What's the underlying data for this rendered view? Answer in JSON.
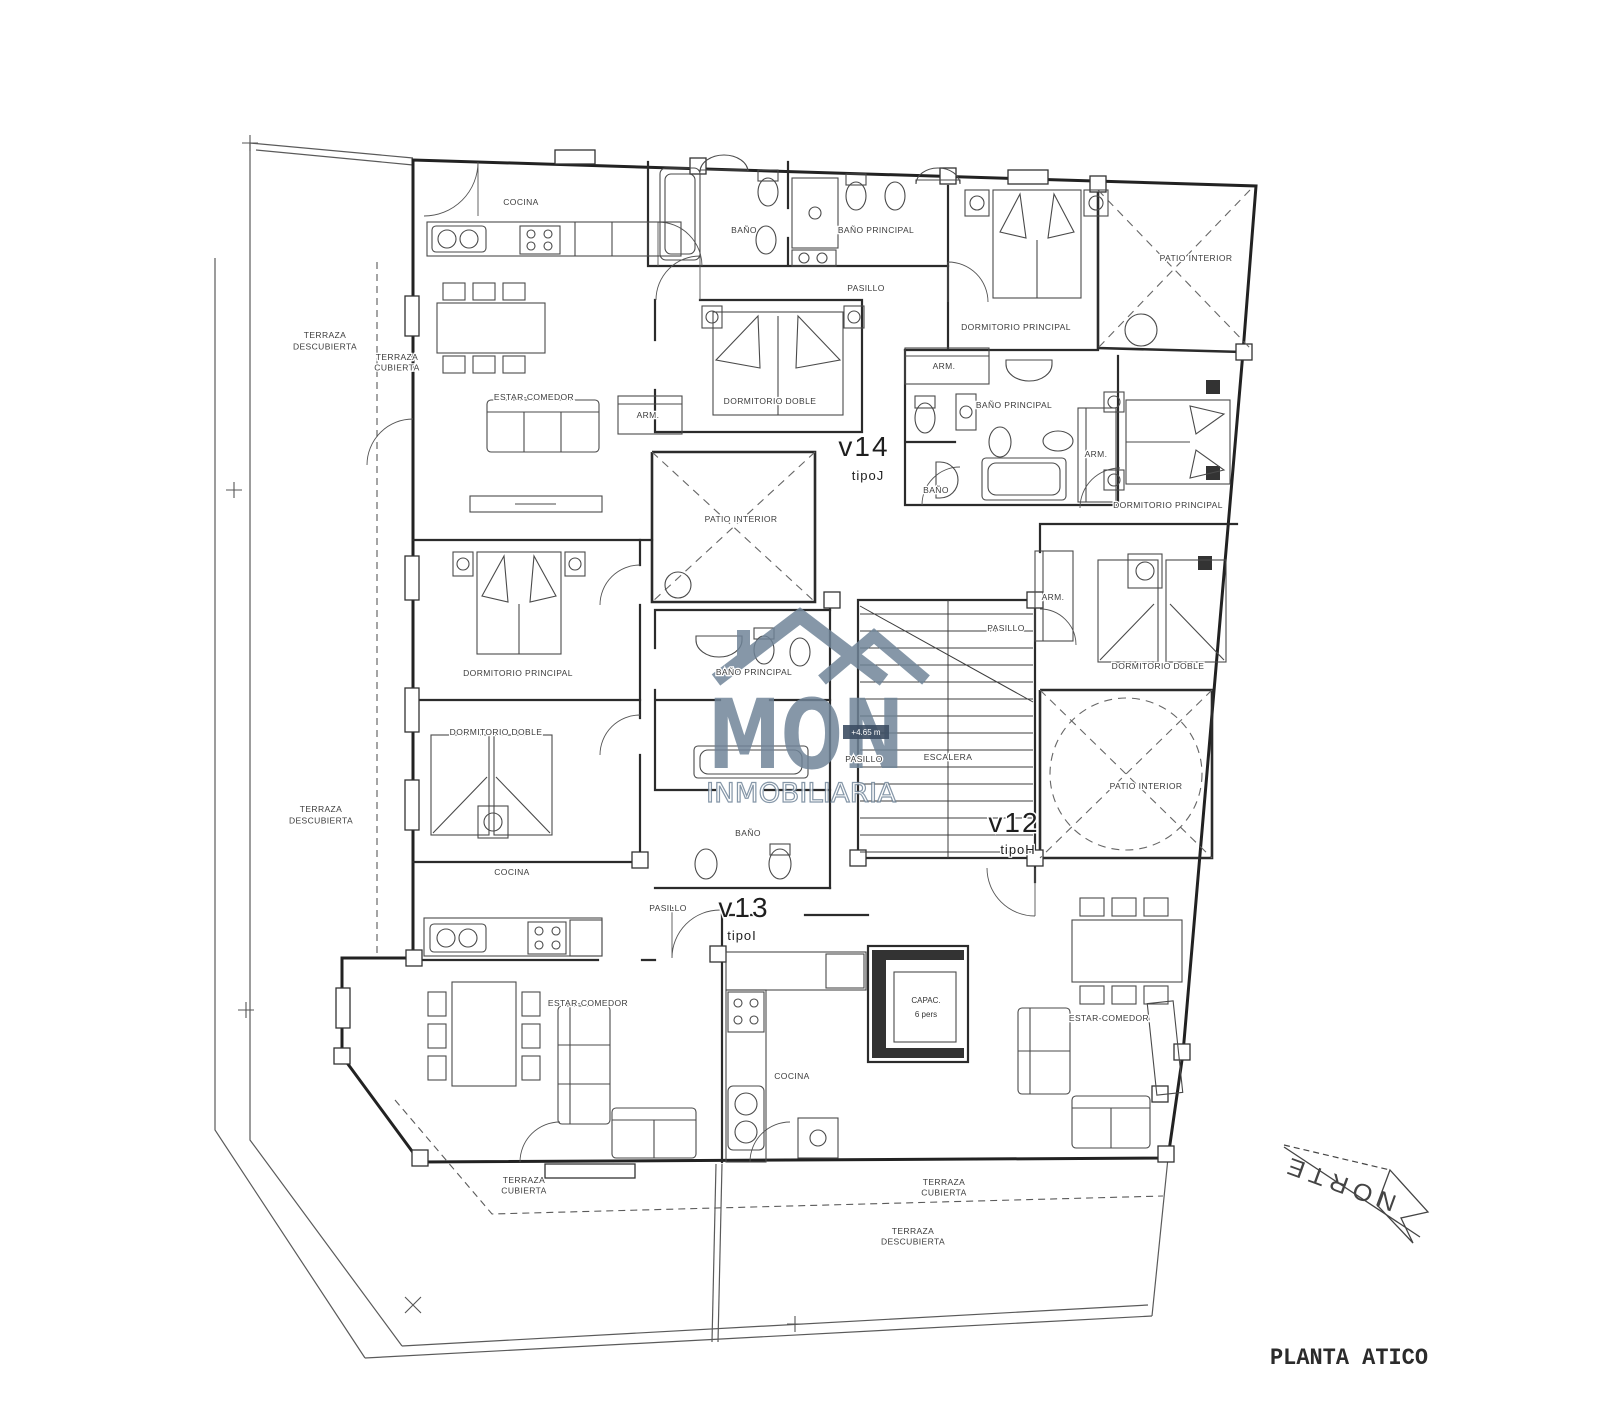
{
  "title": {
    "text": "PLANTA ATICO"
  },
  "north": {
    "label": "NORTE"
  },
  "watermark": {
    "brand": "MON",
    "subtitle": "INMOBILIARIA",
    "color": "#6f8498"
  },
  "level_badge": {
    "text": "+4.65 m"
  },
  "elevator": {
    "line1": "CAPAC.",
    "line2": "6 pers"
  },
  "units": [
    {
      "id": "v12",
      "tipo": "tipoH"
    },
    {
      "id": "v13",
      "tipo": "tipoI"
    },
    {
      "id": "v14",
      "tipo": "tipoJ"
    }
  ],
  "room_labels": [
    {
      "name": "label-cocina-v14",
      "text": "COCINA",
      "x": 521,
      "y": 205
    },
    {
      "name": "label-bano-v14",
      "text": "BAÑO",
      "x": 744,
      "y": 233
    },
    {
      "name": "label-bano-principal-v14",
      "text": "BAÑO PRINCIPAL",
      "x": 876,
      "y": 233
    },
    {
      "name": "label-pasillo-v14",
      "text": "PASILLO",
      "x": 866,
      "y": 291,
      "fs": 7.5
    },
    {
      "name": "label-terraza-descubierta-upper",
      "lines": [
        "TERRAZA",
        "DESCUBIERTA"
      ],
      "x": 325,
      "y": 338
    },
    {
      "name": "label-terraza-cubierta-left",
      "lines": [
        "TERRAZA",
        "CUBIERTA"
      ],
      "x": 397,
      "y": 360,
      "fs": 7.5
    },
    {
      "name": "label-estar-comedor-v14",
      "text": "ESTAR-COMEDOR",
      "x": 534,
      "y": 400
    },
    {
      "name": "label-dormitorio-doble-v14",
      "text": "DORMITORIO DOBLE",
      "x": 770,
      "y": 404
    },
    {
      "name": "label-arm-v14",
      "text": "ARM.",
      "x": 648,
      "y": 418,
      "fs": 7.5
    },
    {
      "name": "label-dormitorio-principal-tr",
      "text": "DORMITORIO PRINCIPAL",
      "x": 1016,
      "y": 330
    },
    {
      "name": "label-arm-tr",
      "text": "ARM.",
      "x": 944,
      "y": 369,
      "fs": 7.5
    },
    {
      "name": "label-patio-interior-tr",
      "text": "PATIO INTERIOR",
      "x": 1196,
      "y": 261
    },
    {
      "name": "unit-v14",
      "text": "v14",
      "x": 864,
      "y": 456,
      "fs": 28,
      "cls": "unit"
    },
    {
      "name": "unit-v14-tipo",
      "text": "tipoJ",
      "x": 868,
      "y": 480,
      "fs": 13,
      "cls": "tipo"
    },
    {
      "name": "label-patio-interior-v14",
      "text": "PATIO INTERIOR",
      "x": 741,
      "y": 522
    },
    {
      "name": "label-bano-principal-v12",
      "text": "BAÑO PRINCIPAL",
      "x": 1014,
      "y": 408
    },
    {
      "name": "label-arm-v12-upper",
      "text": "ARM.",
      "x": 1096,
      "y": 457,
      "fs": 7.5
    },
    {
      "name": "label-bano-v12",
      "text": "BAÑO",
      "x": 936,
      "y": 493
    },
    {
      "name": "label-dormitorio-principal-v12",
      "text": "DORMITORIO PRINCIPAL",
      "x": 1168,
      "y": 508
    },
    {
      "name": "label-arm-v12-mid",
      "text": "ARM.",
      "x": 1053,
      "y": 600,
      "fs": 7.5
    },
    {
      "name": "label-pasillo-v12",
      "text": "PASILLO",
      "x": 1006,
      "y": 631,
      "fs": 7.5
    },
    {
      "name": "label-dormitorio-doble-v12",
      "text": "DORMITORIO DOBLE",
      "x": 1158,
      "y": 669
    },
    {
      "name": "label-patio-interior-v12",
      "text": "PATIO INTERIOR",
      "x": 1146,
      "y": 789
    },
    {
      "name": "unit-v12",
      "text": "v12",
      "x": 1014,
      "y": 832,
      "fs": 28,
      "cls": "unit"
    },
    {
      "name": "unit-v12-tipo",
      "text": "tipoH",
      "x": 1018,
      "y": 854,
      "fs": 13,
      "cls": "tipo"
    },
    {
      "name": "label-dormitorio-principal-v13",
      "text": "DORMITORIO PRINCIPAL",
      "x": 518,
      "y": 676
    },
    {
      "name": "label-bano-principal-v13",
      "text": "BAÑO PRINCIPAL",
      "x": 754,
      "y": 675
    },
    {
      "name": "label-dormitorio-doble-v13",
      "text": "DORMITORIO DOBLE",
      "x": 496,
      "y": 735
    },
    {
      "name": "label-terraza-descubierta-lower",
      "lines": [
        "TERRAZA",
        "DESCUBIERTA"
      ],
      "x": 321,
      "y": 812
    },
    {
      "name": "label-bano-v13",
      "text": "BAÑO",
      "x": 748,
      "y": 836
    },
    {
      "name": "label-cocina-v13",
      "text": "COCINA",
      "x": 512,
      "y": 875
    },
    {
      "name": "label-pasillo-v13",
      "text": "PASILLO",
      "x": 668,
      "y": 911,
      "fs": 7.5
    },
    {
      "name": "unit-v13",
      "text": "v13",
      "x": 744,
      "y": 917,
      "fs": 28,
      "cls": "unit"
    },
    {
      "name": "unit-v13-tipo",
      "text": "tipoI",
      "x": 742,
      "y": 940,
      "fs": 13,
      "cls": "tipo"
    },
    {
      "name": "label-estar-comedor-v13",
      "text": "ESTAR-COMEDOR",
      "x": 588,
      "y": 1006
    },
    {
      "name": "label-escalera",
      "text": "ESCALERA",
      "x": 948,
      "y": 760,
      "fs": 8
    },
    {
      "name": "label-pasillo-core",
      "text": "PASILLO",
      "x": 864,
      "y": 762,
      "fs": 7.5
    },
    {
      "name": "label-cocina-v12",
      "text": "COCINA",
      "x": 792,
      "y": 1079
    },
    {
      "name": "label-estar-comedor-v12",
      "text": "ESTAR-COMEDOR",
      "x": 1109,
      "y": 1021
    },
    {
      "name": "label-terraza-cubierta-bottom-left",
      "lines": [
        "TERRAZA",
        "CUBIERTA"
      ],
      "x": 524,
      "y": 1183,
      "fs": 7.5
    },
    {
      "name": "label-terraza-cubierta-bottom-right",
      "lines": [
        "TERRAZA",
        "CUBIERTA"
      ],
      "x": 944,
      "y": 1185,
      "fs": 7.5
    },
    {
      "name": "label-terraza-descubierta-bottom",
      "lines": [
        "TERRAZA",
        "DESCUBIERTA"
      ],
      "x": 913,
      "y": 1234,
      "fs": 7.5
    }
  ]
}
